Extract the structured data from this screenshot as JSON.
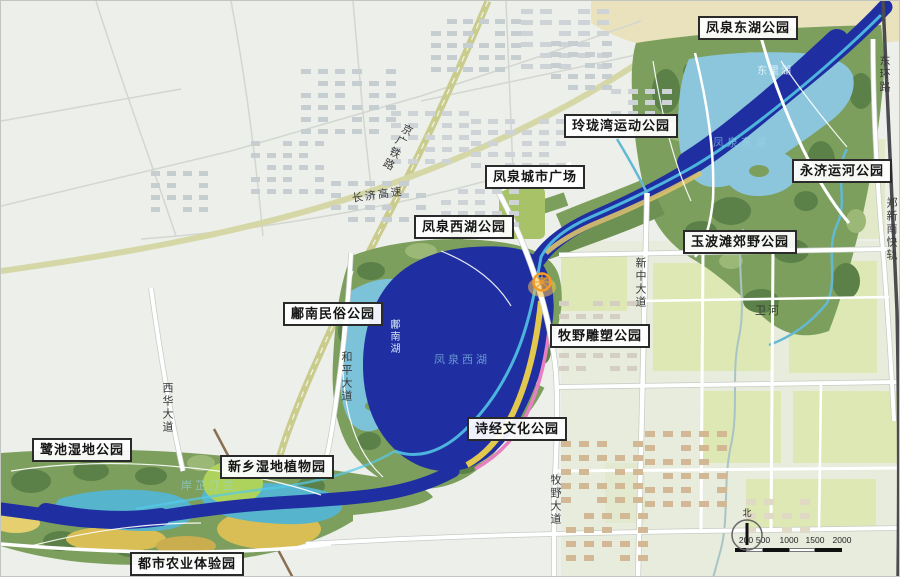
{
  "map": {
    "park_labels": [
      {
        "text": "凤泉东湖公园",
        "x": 697,
        "y": 15
      },
      {
        "text": "玲珑湾运动公园",
        "x": 563,
        "y": 113
      },
      {
        "text": "凤泉城市广场",
        "x": 484,
        "y": 164
      },
      {
        "text": "凤泉西湖公园",
        "x": 413,
        "y": 214
      },
      {
        "text": "永济运河公园",
        "x": 791,
        "y": 158
      },
      {
        "text": "玉波滩郊野公园",
        "x": 682,
        "y": 229
      },
      {
        "text": "鄘南民俗公园",
        "x": 282,
        "y": 301
      },
      {
        "text": "牧野雕塑公园",
        "x": 549,
        "y": 323
      },
      {
        "text": "诗经文化公园",
        "x": 466,
        "y": 416
      },
      {
        "text": "鹭池湿地公园",
        "x": 31,
        "y": 437
      },
      {
        "text": "新乡湿地植物园",
        "x": 219,
        "y": 454
      },
      {
        "text": "都市农业体验园",
        "x": 129,
        "y": 551
      }
    ],
    "road_labels": [
      {
        "text": "东环路",
        "x": 876,
        "y": 54,
        "orient": "v"
      },
      {
        "text": "郑新南快轨",
        "x": 883,
        "y": 196,
        "orient": "v"
      },
      {
        "text": "新中大道",
        "x": 632,
        "y": 256,
        "orient": "v"
      },
      {
        "text": "和平大道",
        "x": 338,
        "y": 350,
        "orient": "v"
      },
      {
        "text": "西华大道",
        "x": 159,
        "y": 381,
        "orient": "v"
      },
      {
        "text": "牧野大道",
        "x": 547,
        "y": 473,
        "orient": "v"
      },
      {
        "text": "京广铁路",
        "x": 402,
        "y": 120,
        "orient": "v",
        "rotate": 28
      },
      {
        "text": "长济高速",
        "x": 350,
        "y": 189,
        "orient": "h",
        "rotate": -8
      },
      {
        "text": "卫河",
        "x": 754,
        "y": 301,
        "orient": "h"
      }
    ],
    "water_labels": [
      {
        "text": "东里湖",
        "x": 756,
        "y": 61,
        "orient": "h"
      },
      {
        "text": "鄘南湖",
        "x": 385,
        "y": 318,
        "orient": "v"
      }
    ],
    "watermarks": [
      {
        "text": "凤泉东湖",
        "x": 712,
        "y": 133
      },
      {
        "text": "凤泉西湖",
        "x": 433,
        "y": 350
      },
      {
        "text": "岸芷汀兰",
        "x": 180,
        "y": 476
      }
    ],
    "scalebar": {
      "ticks": [
        "200",
        "500",
        "1000",
        "1500",
        "2000"
      ],
      "north_label": "北"
    },
    "colors": {
      "river_blue": "#1f2fa2",
      "channel_cyan": "#55cbe8",
      "lake_light": "#8cc6dc",
      "park_green": "#7d9f5e",
      "autumn_yellow": "#d9bd55",
      "city_bg": "#edefea",
      "rail_band": "#c9cc8c"
    }
  }
}
